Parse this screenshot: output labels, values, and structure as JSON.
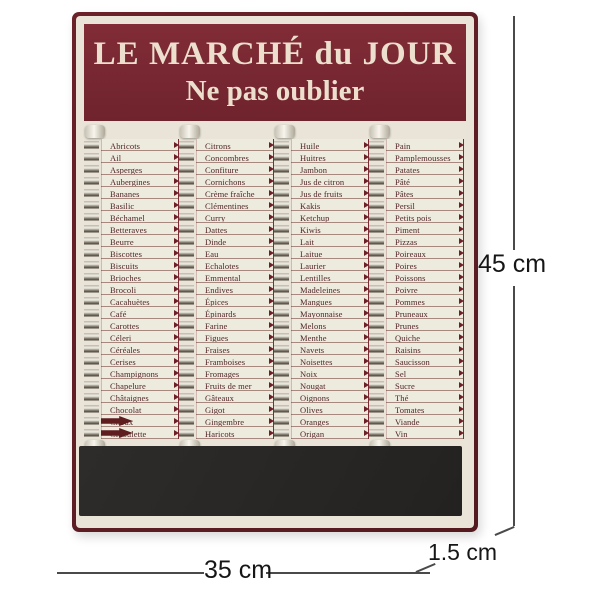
{
  "board": {
    "title_line1": "LE MARCHÉ du JOUR",
    "title_line2": "Ne pas oublier",
    "columns": [
      {
        "items": [
          "Abricots",
          "Ail",
          "Asperges",
          "Aubergines",
          "Bananes",
          "Basilic",
          "Béchamel",
          "Betteraves",
          "Beurre",
          "Biscottes",
          "Biscuits",
          "Brioches",
          "Brocoli",
          "Cacahuètes",
          "Café",
          "Carottes",
          "Céleri",
          "Céréales",
          "Cerises",
          "Champignons",
          "Chapelure",
          "Châtaignes",
          "Chocolat",
          "Choux",
          "Ciboulette"
        ],
        "flipped": [
          23,
          24
        ]
      },
      {
        "items": [
          "Citrons",
          "Concombres",
          "Confiture",
          "Cornichons",
          "Crème fraîche",
          "Clémentines",
          "Curry",
          "Dattes",
          "Dinde",
          "Eau",
          "Echalotes",
          "Emmental",
          "Endives",
          "Épices",
          "Épinards",
          "Farine",
          "Figues",
          "Fraises",
          "Framboises",
          "Fromages",
          "Fruits de mer",
          "Gâteaux",
          "Gigot",
          "Gingembre",
          "Haricots"
        ],
        "flipped": []
      },
      {
        "items": [
          "Huile",
          "Huitres",
          "Jambon",
          "Jus de citron",
          "Jus de fruits",
          "Kakis",
          "Ketchup",
          "Kiwis",
          "Lait",
          "Laitue",
          "Laurier",
          "Lentilles",
          "Madeleines",
          "Mangues",
          "Mayonnaise",
          "Melons",
          "Menthe",
          "Navets",
          "Noisettes",
          "Noix",
          "Nougat",
          "Oignons",
          "Olives",
          "Oranges",
          "Origan"
        ],
        "flipped": []
      },
      {
        "items": [
          "Pain",
          "Pamplemousses",
          "Patates",
          "Pâté",
          "Pâtes",
          "Persil",
          "Petits pois",
          "Piment",
          "Pizzas",
          "Poireaux",
          "Poires",
          "Poissons",
          "Poivre",
          "Pommes",
          "Pruneaux",
          "Prunes",
          "Quiche",
          "Raisins",
          "Saucisson",
          "Sel",
          "Sucre",
          "Thé",
          "Tomates",
          "Viande",
          "Vin"
        ],
        "flipped": []
      }
    ]
  },
  "dimensions": {
    "height_label": "45 cm",
    "width_label": "35 cm",
    "depth_label": "1.5 cm"
  },
  "colors": {
    "board_maroon": "#7a2831",
    "frame_maroon": "#5e1d24",
    "cream": "#e9e4d7",
    "slip_white": "#edeade",
    "slip_text": "#512527",
    "chalkboard_black": "#2b2927",
    "dimension_text": "#161616"
  }
}
